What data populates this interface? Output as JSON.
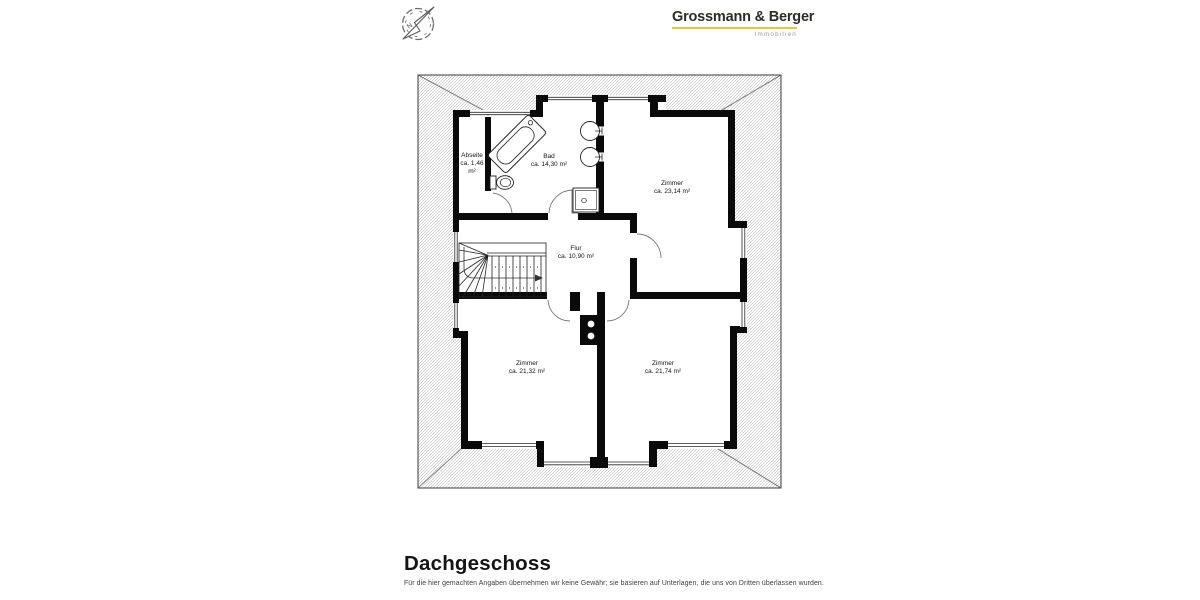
{
  "header": {
    "logo": {
      "name": "Grossmann & Berger",
      "subtitle": "Immobilien",
      "underline_color": "#e6c63c"
    },
    "compass": {
      "north_label": "N"
    }
  },
  "floorplan": {
    "floor": "Dachgeschoss",
    "rooms": {
      "abseite": {
        "name": "Abseite",
        "line2": "ca. 1,46",
        "line3": "m²"
      },
      "bad": {
        "name": "Bad",
        "line2": "ca. 14,30 m²",
        "line3": ""
      },
      "zimmer_23_14": {
        "name": "Zimmer",
        "line2": "ca. 23,14 m²",
        "line3": ""
      },
      "flur": {
        "name": "Flur",
        "line2": "ca. 10,90 m²",
        "line3": ""
      },
      "zimmer_21_32": {
        "name": "Zimmer",
        "line2": "ca. 21,32 m²",
        "line3": ""
      },
      "zimmer_21_74": {
        "name": "Zimmer",
        "line2": "ca. 21,74 m²",
        "line3": ""
      }
    },
    "colors": {
      "wall": "#0a0a0a",
      "hatch": "#b5b5b5"
    }
  },
  "footer": {
    "title": "Dachgeschoss",
    "disclaimer": "Für die hier gemachten Angaben übernehmen wir keine Gewähr; sie basieren auf Unterlagen, die uns von Dritten überlassen wurden."
  }
}
